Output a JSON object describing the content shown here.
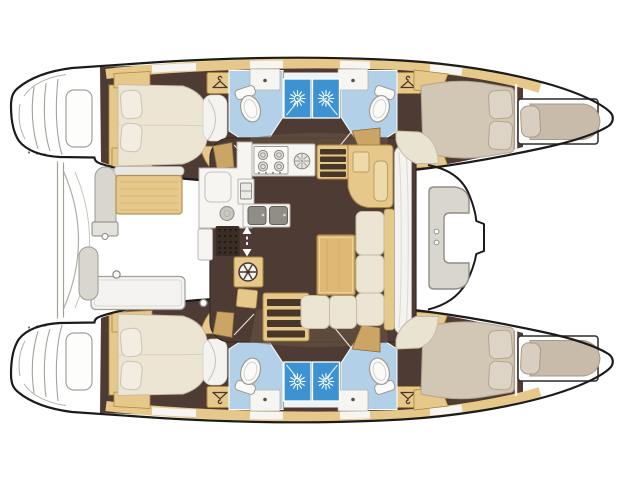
{
  "page": {
    "background": "#ffffff",
    "description": "Catamaran sailing yacht interior layout plan, top-down view, bows to the right"
  },
  "colors": {
    "outline": "#1b1b1b",
    "floor_brown": "#4e3b33",
    "corridor_brown": "#6b5746",
    "wood": "#e7c88b",
    "wood_dark": "#cba566",
    "wood_border": "#a9863f",
    "stair_tread": "#483629",
    "mattress_cream": "#ece5d3",
    "mattress_border": "#c7bca4",
    "pillow_white": "#f1ede1",
    "pillow_border": "#cdc4b0",
    "mattress_taupe": "#c8bbaa",
    "taupe_border": "#a89a87",
    "bath_floor_blue": "#b2d1e9",
    "shower_blue": "#3d93d1",
    "white_surface": "#f6f5f2",
    "gray_surface": "#d9d6ce",
    "gray_line": "#9d9a92",
    "table_wood": "#deb976",
    "pad_tan": "#eed9a8",
    "pod_cream": "#e9e3d2",
    "entry_mat": "#3a2d25"
  },
  "icons": [
    {
      "name": "shower-sun-icon",
      "meaning": "shower fitting",
      "count": 4
    },
    {
      "name": "wardrobe-hanger-icon",
      "meaning": "hanging locker",
      "count": 4
    },
    {
      "name": "stove-burner-icon",
      "meaning": "galley burner",
      "count": 4
    },
    {
      "name": "ventilation-fan-icon",
      "meaning": "fan vent",
      "count": 1
    },
    {
      "name": "companionway-arrows-icon",
      "meaning": "entry direction arrows",
      "count": 1
    }
  ],
  "features": {
    "hulls": 2,
    "double_cabins": 4,
    "forepeak_berths": 2,
    "toilets": 4,
    "washbasins": 4,
    "shower_stalls": 4,
    "companionway_stairs": 2,
    "saloon_sofa_cushions": 5,
    "cockpit_tables": 1,
    "galley_sinks": 2
  }
}
